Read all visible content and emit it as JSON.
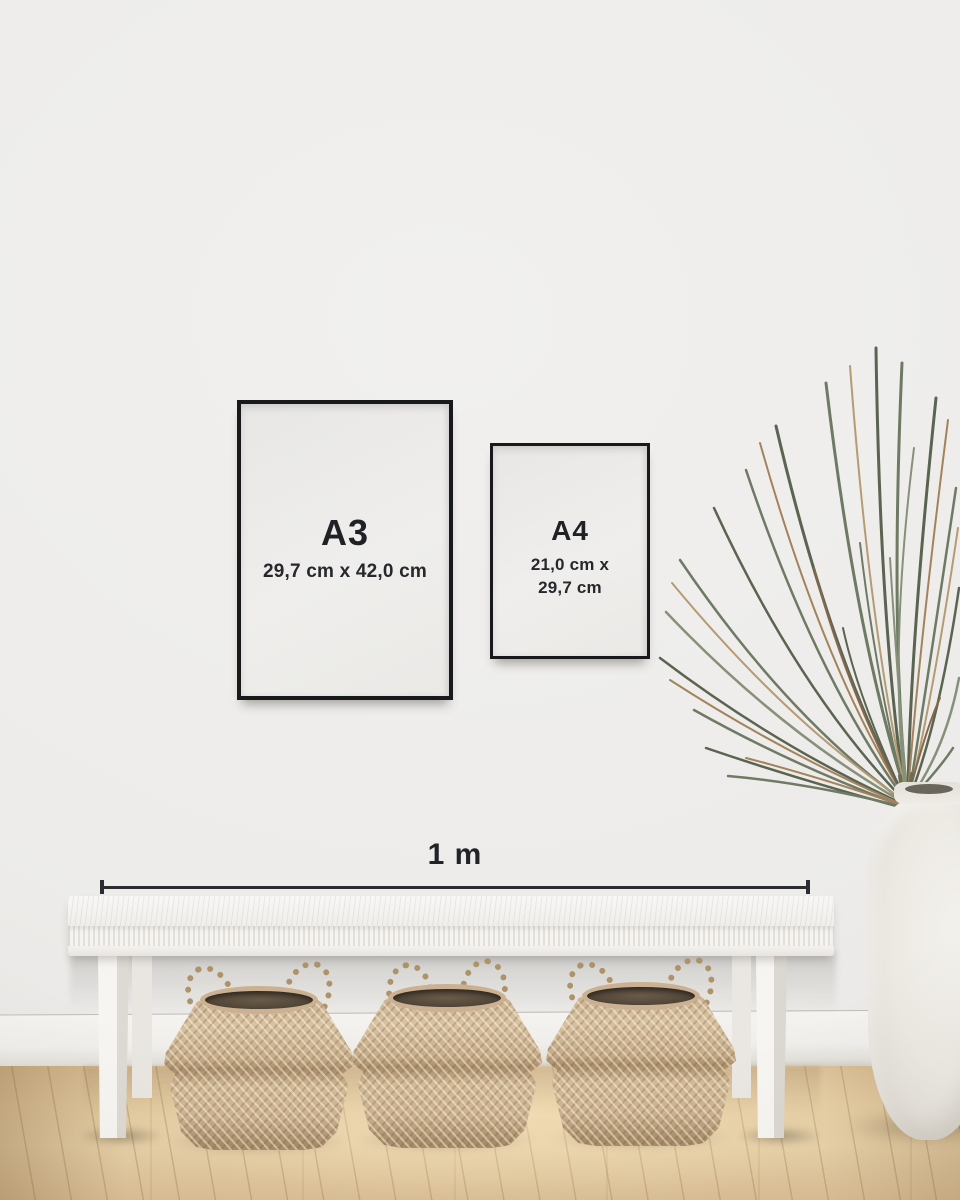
{
  "frames": [
    {
      "label": "A3",
      "dimensions_lines": [
        "29,7 cm x 42,0 cm"
      ]
    },
    {
      "label": "A4",
      "dimensions_lines": [
        "21,0 cm x",
        "29,7 cm"
      ]
    }
  ],
  "scale": {
    "label": "1 m"
  },
  "palette": {
    "frame_border": "#17191C",
    "label_text": "#1F2124",
    "scale_line": "#2B2D30",
    "wall": "#EDECEA",
    "baseboard": "#F2F1EE",
    "floor_wood": "#E4CBA1",
    "bench_white": "#F4F2EF",
    "basket_seagrass": "#C8AE8C",
    "basket_interior": "#574A3B",
    "vase_ceramic": "#ECE9E3",
    "plant_green": "#6E7A64",
    "plant_brown": "#A3835B"
  }
}
